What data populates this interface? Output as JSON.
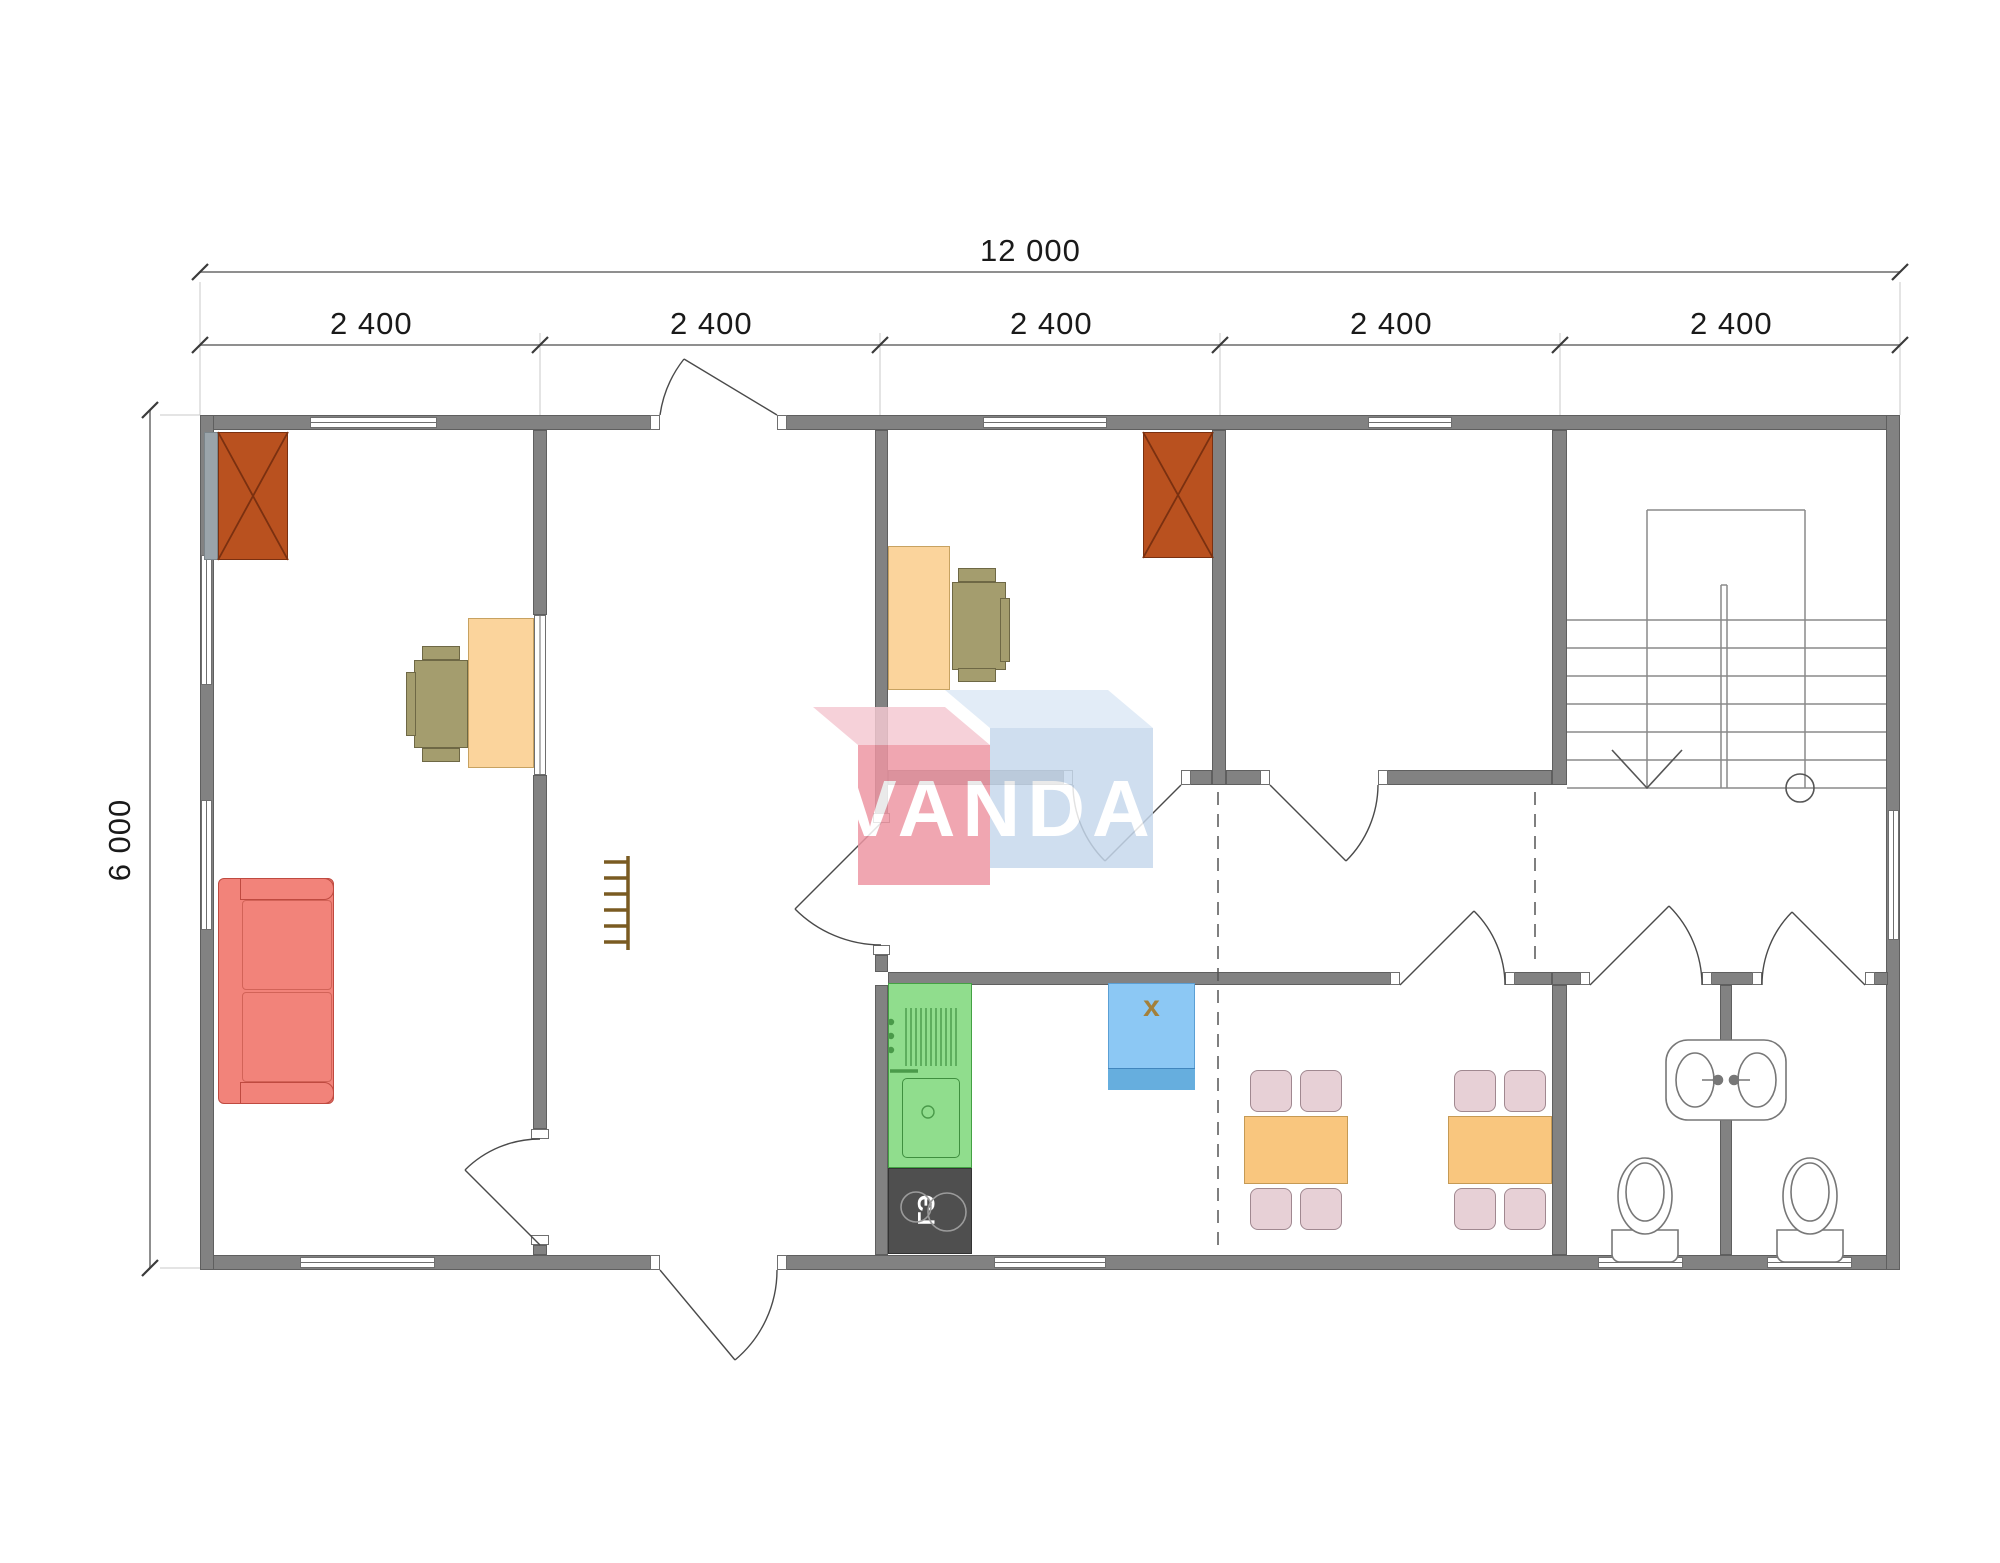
{
  "document": {
    "type": "architectural floor plan",
    "building_width_mm": "12 000",
    "building_depth_mm": "6 000"
  },
  "dimensions": {
    "overall_width_label": "12 000",
    "segment_labels": [
      "2 400",
      "2 400",
      "2 400",
      "2 400",
      "2 400"
    ],
    "overall_height_label": "6 000"
  },
  "watermark": {
    "text": "VANDA"
  },
  "kitchen": {
    "stove_label": "ГЭ",
    "appliance_label": "x"
  },
  "rooms": {
    "living_room": "living room with sofa, desk and stove",
    "entry_hall": "entry hall with ladder",
    "office_room": "room with desk and stove",
    "empty_room": "empty room",
    "stair_hall": "stair hall",
    "corridor": "corridor",
    "kitchen_dining": "kitchen and dining room",
    "bathroom_1": "WC 1 with toilet and sink",
    "bathroom_2": "WC 2 with toilet and sink"
  },
  "colors": {
    "wall": "#828282",
    "wall-edge": "#5f5f5f",
    "fixture-red": "#b9511f",
    "desk": "#fbd49c",
    "desk-edge": "#c7a261",
    "chair": "#a49d6e",
    "chair-edge": "#6e6845",
    "sofa": "#f2837a",
    "sofa-edge": "#bf4a40",
    "kitchen": "#90dd8d",
    "kitchen-edge": "#44a144",
    "stove-dark": "#4f4f4f",
    "appliance-blue": "#8cc8f4",
    "appliance-blue-edge": "#5b9fd4",
    "table": "#f9c67e",
    "table-edge": "#c59a55",
    "dining-chair": "#e7d0d6",
    "dining-chair-edge": "#a08890",
    "dim-text": "#1a1a1a"
  }
}
